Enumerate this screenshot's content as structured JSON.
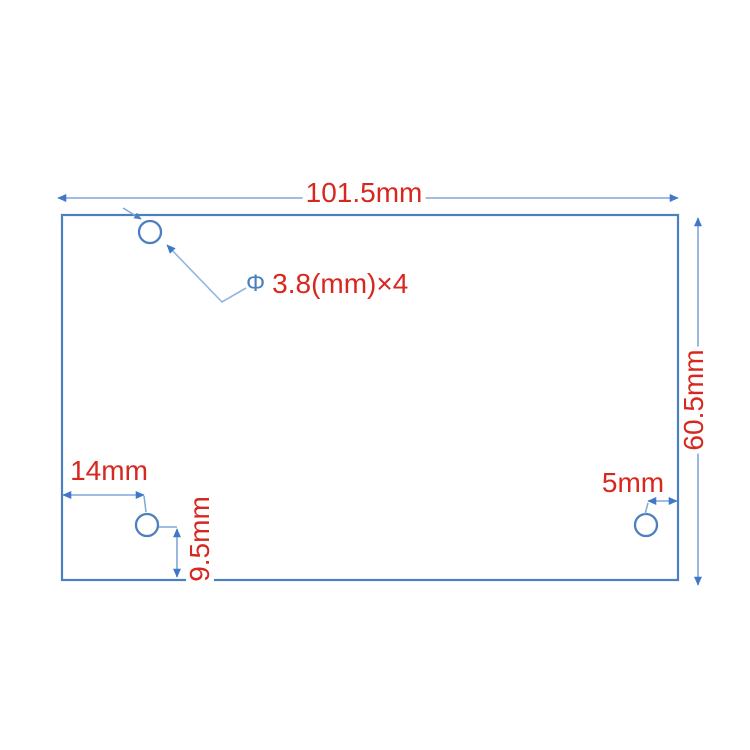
{
  "colors": {
    "background": "#ffffff",
    "board_outline": "#4c7fbf",
    "dimension_line": "#7fa7d9",
    "arrowhead": "#3f78c8",
    "label_red": "#d8271e",
    "diameter_symbol_blue": "#4c7fbf"
  },
  "dimensions": {
    "board_width": {
      "label": "101.5mm"
    },
    "board_height": {
      "label": "60.5mm"
    },
    "hole_diameter": {
      "symbol": "Φ",
      "label": "3.8(mm)×4"
    },
    "hole_offset_left": {
      "label": "14mm"
    },
    "hole_offset_bottom": {
      "label": "9.5mm"
    },
    "hole_offset_right": {
      "label": "5mm"
    }
  }
}
